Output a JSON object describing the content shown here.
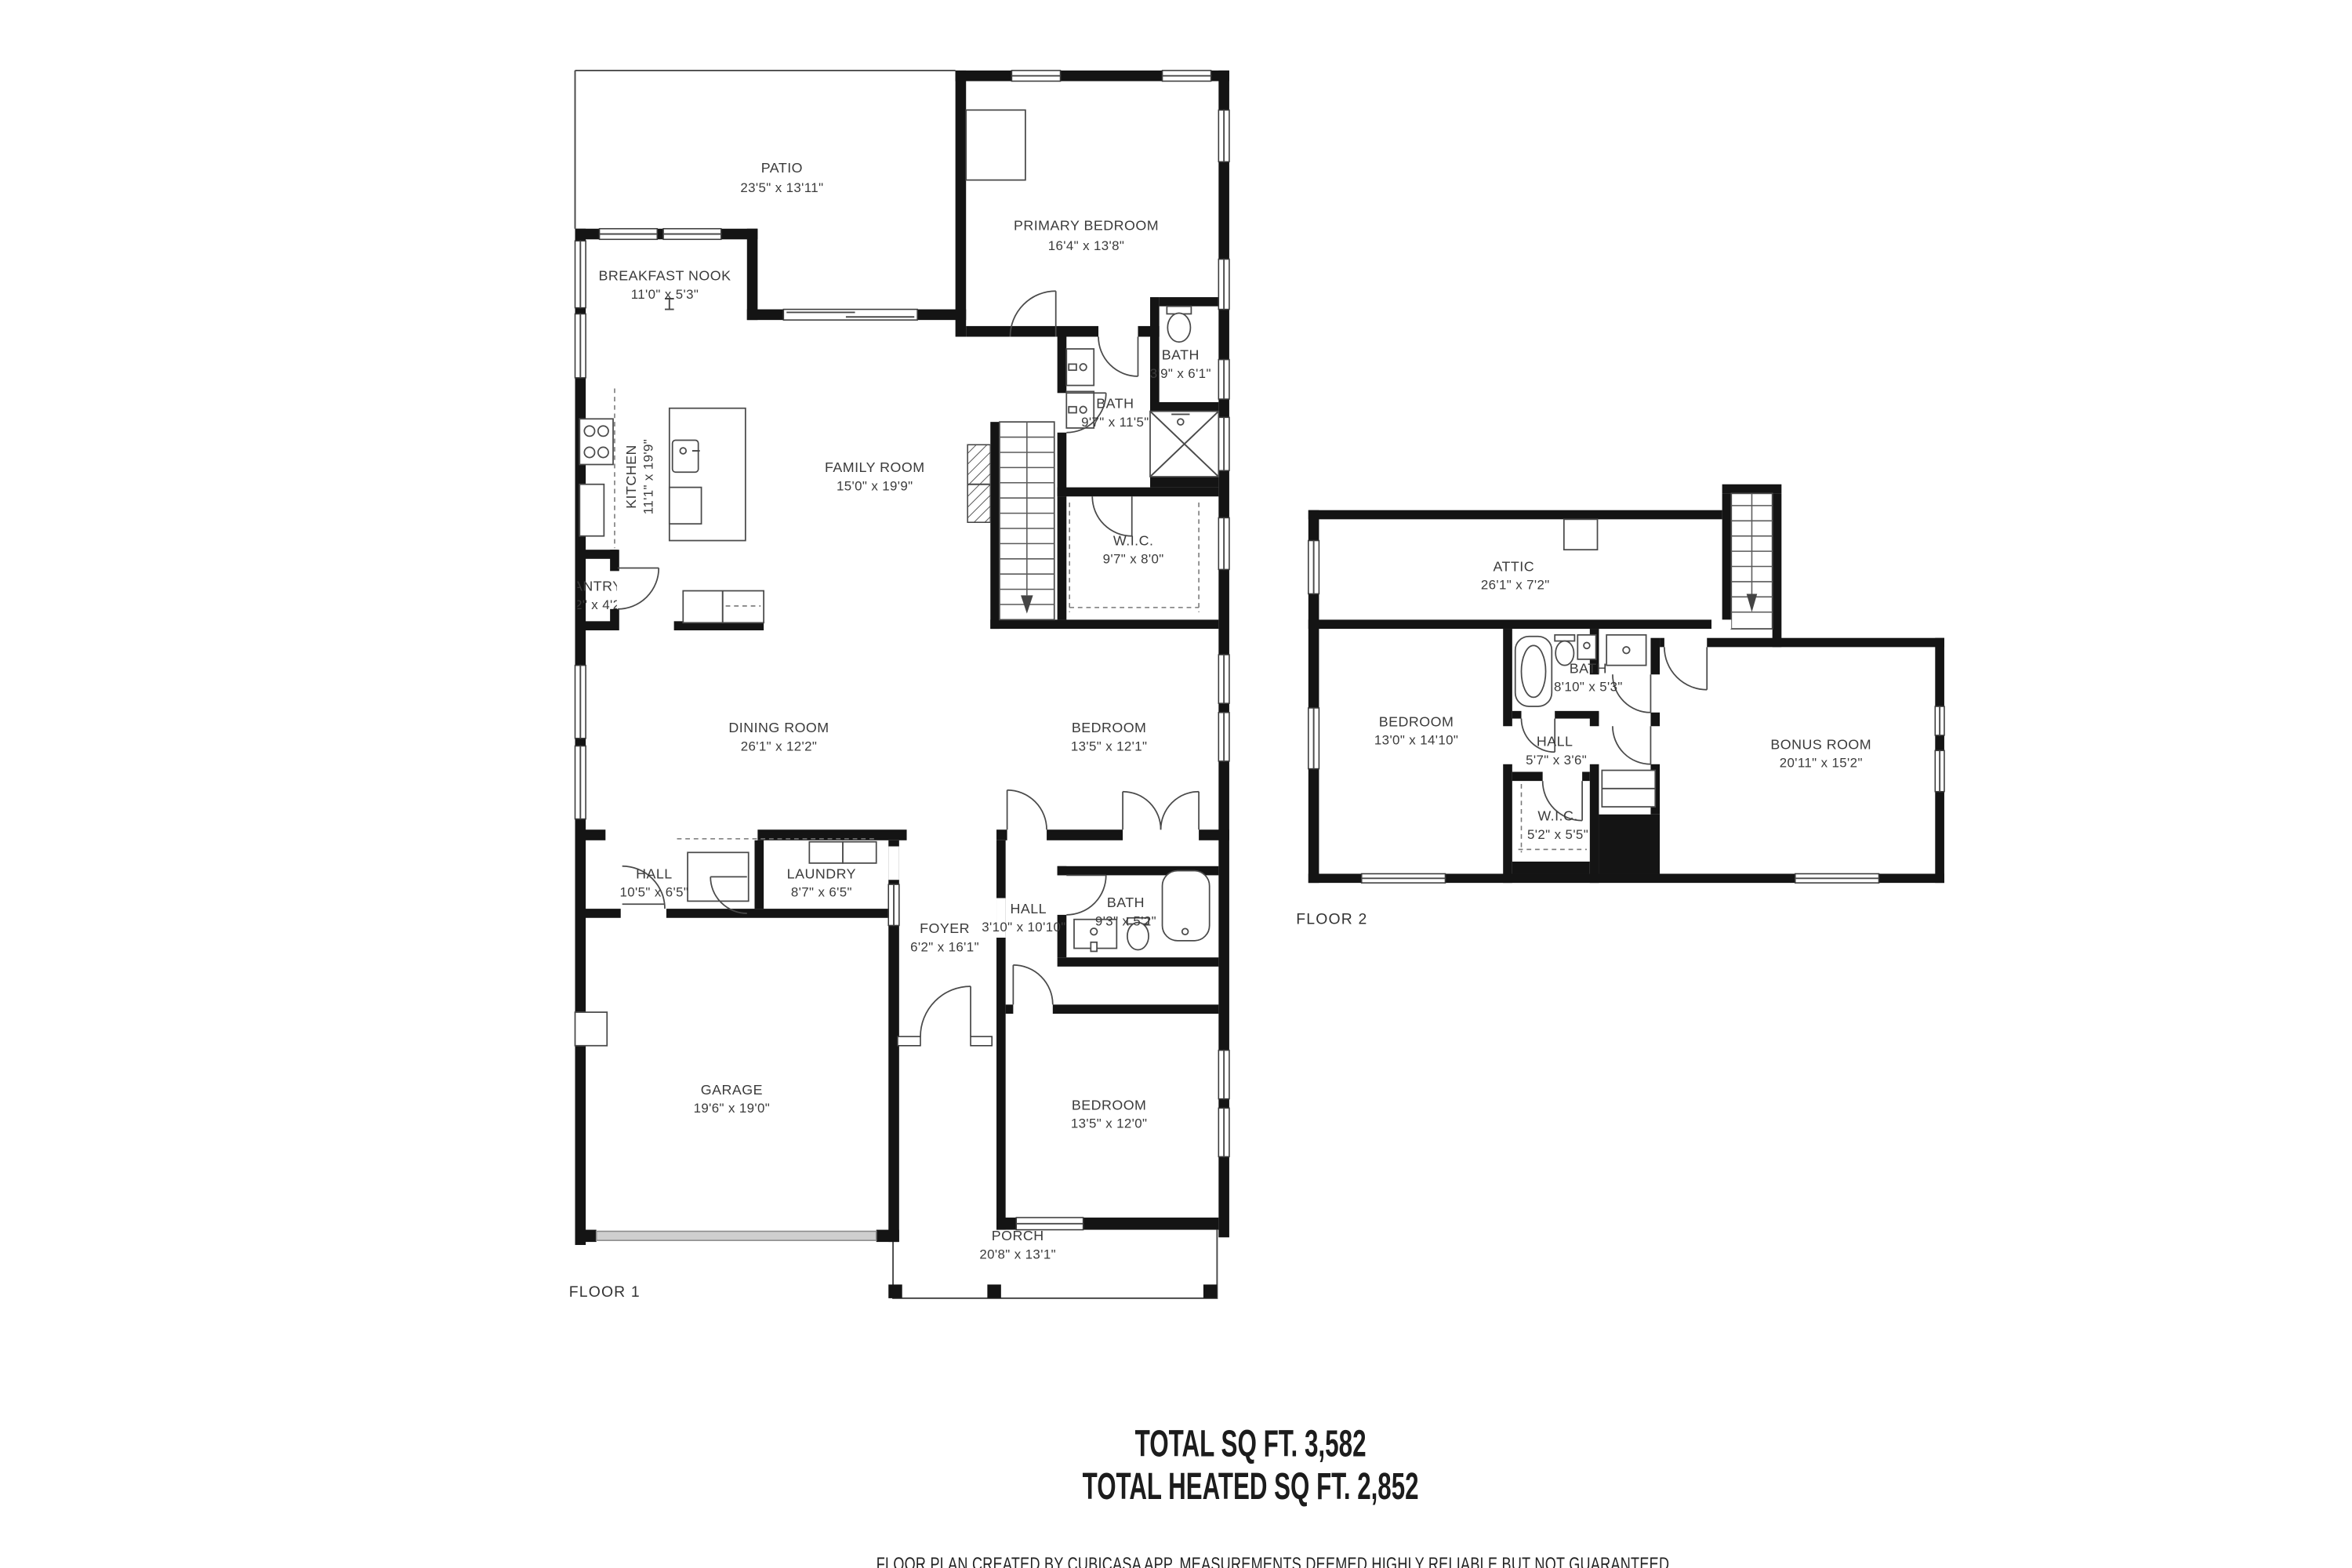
{
  "colors": {
    "wall": "#141414",
    "line": "#4a4a4a",
    "text": "#3b3b3b",
    "background": "#ffffff"
  },
  "floor1": {
    "title": "FLOOR 1",
    "rooms": [
      {
        "name": "PATIO",
        "dims": "23'5\" x 13'11\""
      },
      {
        "name": "PRIMARY BEDROOM",
        "dims": "16'4\" x 13'8\""
      },
      {
        "name": "BREAKFAST NOOK",
        "dims": "11'0\" x 5'3\""
      },
      {
        "name": "BATH",
        "dims": "3'9\" x 6'1\""
      },
      {
        "name": "BATH",
        "dims": "9'7\" x 11'5\""
      },
      {
        "name": "KITCHEN",
        "dims": "11'1\" x 19'9\""
      },
      {
        "name": "FAMILY ROOM",
        "dims": "15'0\" x 19'9\""
      },
      {
        "name": "W.I.C.",
        "dims": "9'7\" x 8'0\""
      },
      {
        "name": "PANTRY",
        "dims": "2'2\" x 4'2\""
      },
      {
        "name": "DINING ROOM",
        "dims": "26'1\" x 12'2\""
      },
      {
        "name": "BEDROOM",
        "dims": "13'5\" x 12'1\""
      },
      {
        "name": "HALL",
        "dims": "10'5\" x 6'5\""
      },
      {
        "name": "LAUNDRY",
        "dims": "8'7\" x 6'5\""
      },
      {
        "name": "FOYER",
        "dims": "6'2\" x 16'1\""
      },
      {
        "name": "HALL",
        "dims": "3'10\" x 10'10\""
      },
      {
        "name": "BATH",
        "dims": "9'3\" x 5'2\""
      },
      {
        "name": "GARAGE",
        "dims": "19'6\" x 19'0\""
      },
      {
        "name": "BEDROOM",
        "dims": "13'5\" x 12'0\""
      },
      {
        "name": "PORCH",
        "dims": "20'8\" x 13'1\""
      }
    ]
  },
  "floor2": {
    "title": "FLOOR 2",
    "rooms": [
      {
        "name": "ATTIC",
        "dims": "26'1\" x 7'2\""
      },
      {
        "name": "BEDROOM",
        "dims": "13'0\" x 14'10\""
      },
      {
        "name": "BATH",
        "dims": "8'10\" x 5'3\""
      },
      {
        "name": "HALL",
        "dims": "5'7\" x 3'6\""
      },
      {
        "name": "W.I.C.",
        "dims": "5'2\" x 5'5\""
      },
      {
        "name": "BONUS ROOM",
        "dims": "20'11\" x 15'2\""
      }
    ]
  },
  "summary": {
    "total": "TOTAL SQ FT. 3,582",
    "heated": "TOTAL HEATED SQ FT. 2,852",
    "disclaimer": "FLOOR PLAN CREATED BY CUBICASA APP. MEASUREMENTS DEEMED HIGHLY RELIABLE BUT NOT GUARANTEED."
  }
}
